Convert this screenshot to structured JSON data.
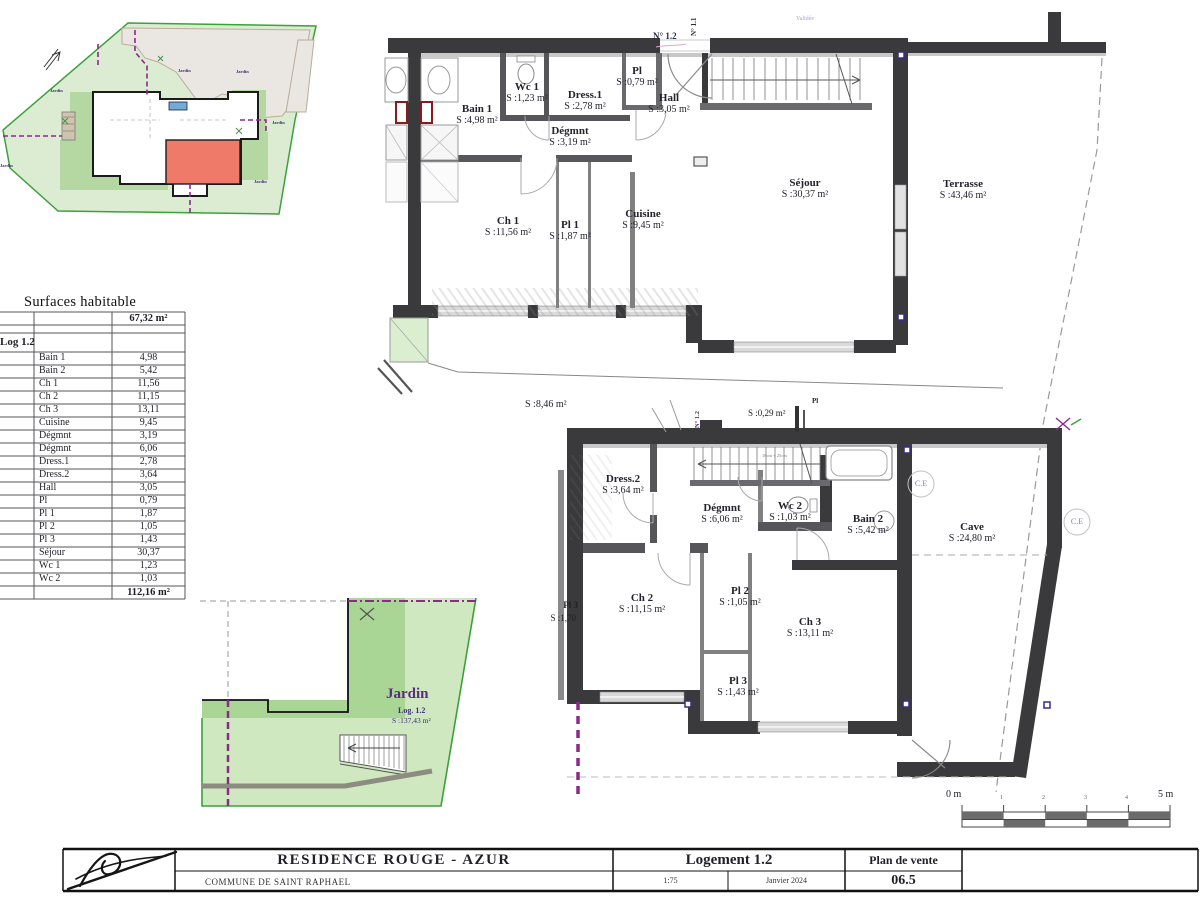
{
  "surfaces_table": {
    "title": "Surfaces habitable",
    "subtotal": "67,32 m²",
    "group": "Log 1.2",
    "rows": [
      {
        "name": "Bain 1",
        "value": "4,98"
      },
      {
        "name": "Bain 2",
        "value": "5,42"
      },
      {
        "name": "Ch 1",
        "value": "11,56"
      },
      {
        "name": "Ch 2",
        "value": "11,15"
      },
      {
        "name": "Ch 3",
        "value": "13,11"
      },
      {
        "name": "Cuisine",
        "value": "9,45"
      },
      {
        "name": "Dégmnt",
        "value": "3,19"
      },
      {
        "name": "Dégmnt",
        "value": "6,06"
      },
      {
        "name": "Dress.1",
        "value": "2,78"
      },
      {
        "name": "Dress.2",
        "value": "3,64"
      },
      {
        "name": "Hall",
        "value": "3,05"
      },
      {
        "name": "Pl",
        "value": "0,79"
      },
      {
        "name": "Pl 1",
        "value": "1,87"
      },
      {
        "name": "Pl 2",
        "value": "1,05"
      },
      {
        "name": "Pl 3",
        "value": "1,43"
      },
      {
        "name": "Séjour",
        "value": "30,37"
      },
      {
        "name": "Wc 1",
        "value": "1,23"
      },
      {
        "name": "Wc 2",
        "value": "1,03"
      }
    ],
    "total": "112,16 m²"
  },
  "upper_plan": {
    "unit_tag": "N° 1.2",
    "neighbor_tag": "N° 1.1",
    "stamp": "Validée",
    "garden_strip_area": "S :8,46 m²",
    "rooms": [
      {
        "name": "Bain 1",
        "area": "S :4,98 m²"
      },
      {
        "name": "Wc 1",
        "area": "S :1,23 m²"
      },
      {
        "name": "Dress.1",
        "area": "S :2,78 m²"
      },
      {
        "name": "Pl",
        "area": "S :0,79 m²"
      },
      {
        "name": "Hall",
        "area": "S :3,05 m²"
      },
      {
        "name": "Dégmnt",
        "area": "S :3,19 m²"
      },
      {
        "name": "Ch 1",
        "area": "S :11,56 m²"
      },
      {
        "name": "Pl 1",
        "area": "S :1,87 m²"
      },
      {
        "name": "Cuisine",
        "area": "S :9,45 m²"
      },
      {
        "name": "Séjour",
        "area": "S :30,37 m²"
      },
      {
        "name": "Terrasse",
        "area": "S :43,46 m²"
      }
    ]
  },
  "lower_plan": {
    "unit_tag": "N° 1.2",
    "stair_note": "18cm + 25cm",
    "ce_label": "C.E",
    "closet": {
      "name": "Pl",
      "area": "S :0,29 m²"
    },
    "neighbor_closet": {
      "name": "Pl 3",
      "area": "S :1,70"
    },
    "rooms": [
      {
        "name": "Dress.2",
        "area": "S :3,64 m²"
      },
      {
        "name": "Dégmnt",
        "area": "S :6,06 m²"
      },
      {
        "name": "Wc 2",
        "area": "S :1,03 m²"
      },
      {
        "name": "Bain 2",
        "area": "S :5,42 m²"
      },
      {
        "name": "Cave",
        "area": "S :24,80 m²"
      },
      {
        "name": "Ch 2",
        "area": "S :11,15 m²"
      },
      {
        "name": "Pl 2",
        "area": "S :1,05 m²"
      },
      {
        "name": "Ch 3",
        "area": "S :13,11 m²"
      },
      {
        "name": "Pl 3",
        "area": "S :1,43 m²"
      }
    ]
  },
  "garden_plan": {
    "name": "Jardin",
    "unit": "Log. 1.2",
    "area": "S :137,43 m²"
  },
  "site_plan": {
    "jardin_label": "Jardin"
  },
  "scale_bar": {
    "start": "0 m",
    "end": "5 m",
    "ticks": [
      "1",
      "2",
      "3",
      "4"
    ]
  },
  "title_block": {
    "project": "RESIDENCE  ROUGE - AZUR",
    "location": "COMMUNE DE SAINT RAPHAEL",
    "unit": "Logement 1.2",
    "scale": "1:75",
    "date": "Janvier 2024",
    "doc_type": "Plan de vente",
    "sheet": "06.5"
  },
  "colors": {
    "wall": "#3a3a3c",
    "site_green": "#dcecd2",
    "unit_red": "#f07a6a",
    "utility_purple": "#8b2a8b",
    "water_blue": "#72aad8"
  }
}
